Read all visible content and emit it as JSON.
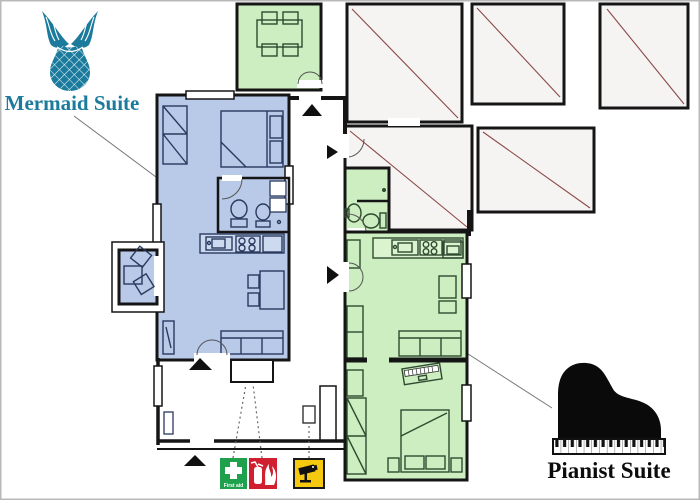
{
  "title_labels": {
    "mermaid": "Mermaid Suite",
    "pianist": "Pianist Suite"
  },
  "safety": {
    "first_aid_label": "First aid",
    "items": [
      {
        "icon": "first-aid-icon",
        "label": "First aid",
        "color": "#1fa04c"
      },
      {
        "icon": "fire-extinguisher-icon",
        "label": "",
        "color": "#d01f2f"
      },
      {
        "icon": "cctv-camera-icon",
        "label": "",
        "color": "#f5c90f"
      }
    ]
  },
  "colors": {
    "wall": "#151515",
    "mermaid_fill": "#b9c9e8",
    "mermaid_light": "#ccd9ef",
    "mermaid_accent": "#1c7b9c",
    "pianist_fill": "#cdeec0",
    "pianist_light": "#dbf3cf",
    "hatch_fill": "#f6f4f2",
    "hatch_line": "#8a4a4a",
    "firstaid_green": "#1fa04c",
    "fire_red": "#d01f2f",
    "cctv_yellow": "#f5c90f",
    "pointer": "#777777"
  },
  "floorplan": {
    "suites": [
      {
        "name": "Mermaid Suite",
        "fill": "#b9c9e8",
        "visible_features": [
          "double-bed",
          "wardrobe",
          "bathroom-toilet-sink",
          "kitchen-sink-stove",
          "dining-table-chairs",
          "sofa",
          "tv-unit",
          "balcony-table-chairs"
        ]
      },
      {
        "name": "Pianist Suite",
        "fill": "#cdeec0",
        "visible_features": [
          "bathroom-sink-toilet-shower",
          "kitchen-sink-stove",
          "armchair",
          "sofa",
          "digital-piano",
          "double-bed",
          "wardrobes"
        ]
      }
    ],
    "shared_areas": [
      "terrace-dining-room",
      "corridor",
      "entrance-hall"
    ],
    "hatched_rooms_count": 5,
    "entrance_arrows_count": 5
  },
  "icons": [
    "mermaid-tail-icon",
    "grand-piano-icon",
    "first-aid-icon",
    "fire-extinguisher-icon",
    "cctv-camera-icon",
    "entrance-arrow"
  ]
}
